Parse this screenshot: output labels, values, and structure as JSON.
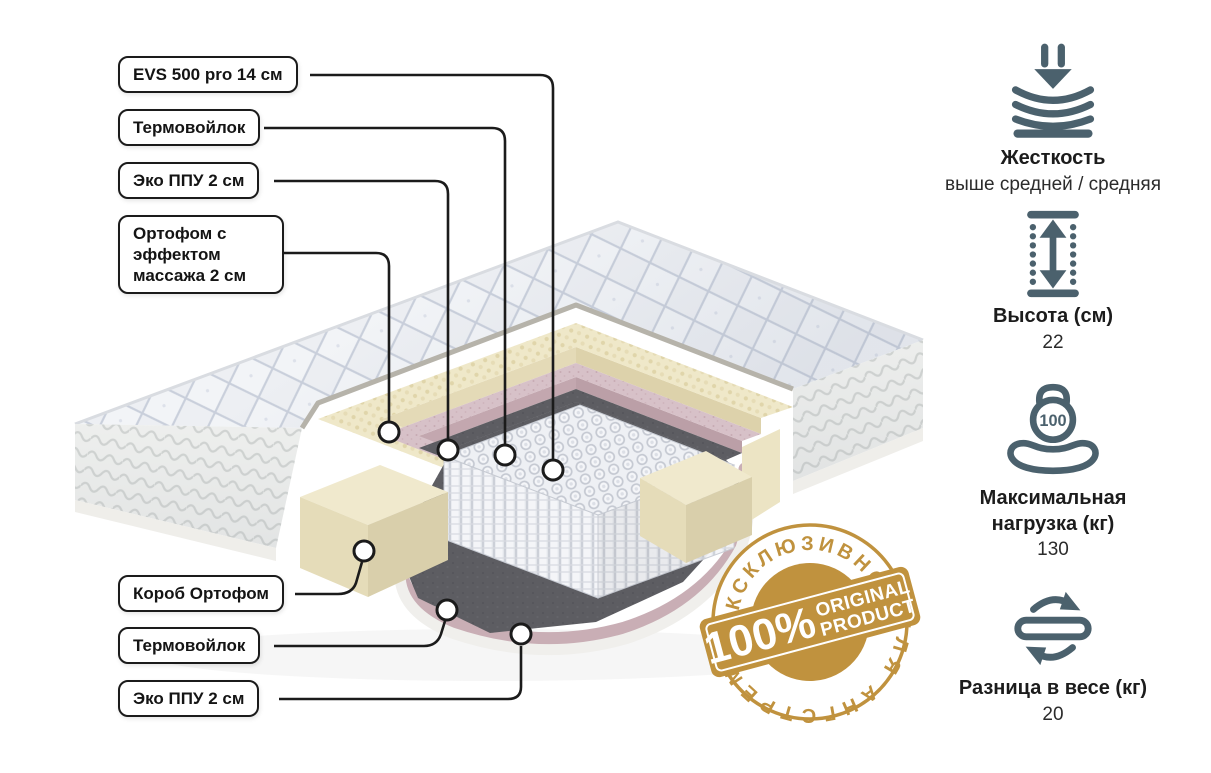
{
  "diagram": {
    "callouts": [
      {
        "label": "EVS 500 pro 14 см"
      },
      {
        "label": "Термовойлок"
      },
      {
        "label": "Эко ППУ 2 см"
      },
      {
        "label": "Ортофом с эффектом массажа 2 см"
      },
      {
        "label": "Короб Ортофом"
      },
      {
        "label": "Термовойлок"
      },
      {
        "label": "Эко ППУ 2 см"
      }
    ]
  },
  "specs": [
    {
      "icon": "firmness-icon",
      "title": "Жесткость",
      "value": "выше средней / средняя"
    },
    {
      "icon": "height-icon",
      "title": "Высота (см)",
      "value": "22"
    },
    {
      "icon": "max-load-icon",
      "title": "Максимальная нагрузка (кг)",
      "value": "130",
      "icon_text": "100"
    },
    {
      "icon": "flip-icon",
      "title": "Разница в весе (кг)",
      "value": "20"
    }
  ],
  "badge": {
    "top_arc": "ЭКСКЛЮЗИВНО",
    "percent": "100%",
    "line1": "ORIGINAL",
    "line2": "PRODUCT",
    "bottom_arc": "ДЛЯ АНГСТРЕМ"
  },
  "colors": {
    "badge_gold": "#c0923e",
    "icon_slate": "#4b616d"
  }
}
